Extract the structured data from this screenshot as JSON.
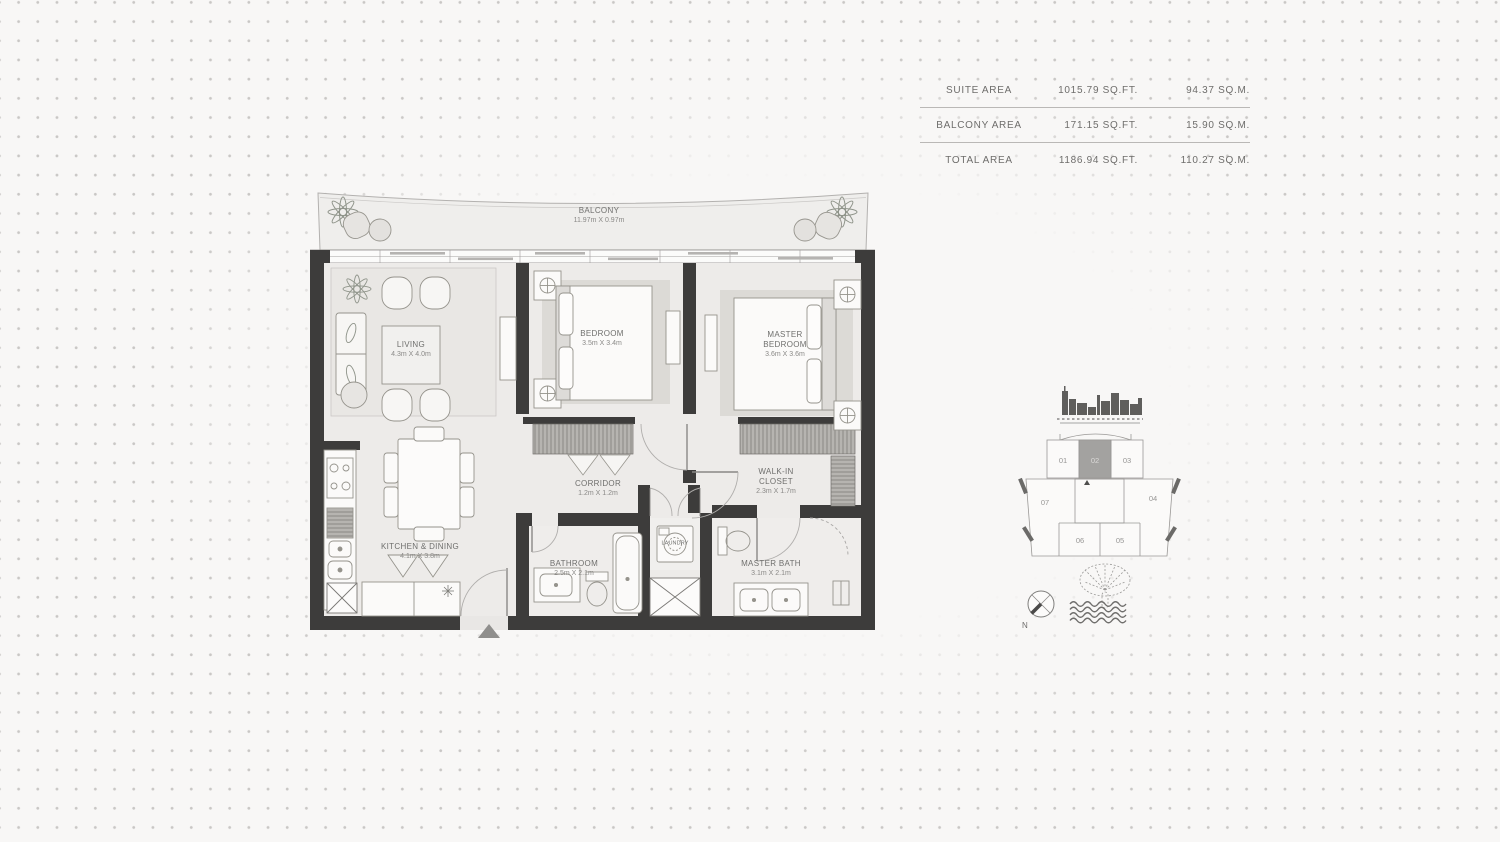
{
  "area_table": {
    "rows": [
      {
        "label": "SUITE AREA",
        "sqft": "1015.79 SQ.FT.",
        "sqm": "94.37 SQ.M."
      },
      {
        "label": "BALCONY AREA",
        "sqft": "171.15 SQ.FT.",
        "sqm": "15.90 SQ.M."
      },
      {
        "label": "TOTAL AREA",
        "sqft": "1186.94 SQ.FT.",
        "sqm": "110.27 SQ.M."
      }
    ]
  },
  "floorplan": {
    "rooms": [
      {
        "name": "BALCONY",
        "dims": "11.97m X 0.97m"
      },
      {
        "name": "LIVING",
        "dims": "4.3m X 4.0m"
      },
      {
        "name": "BEDROOM",
        "dims": "3.5m X 3.4m"
      },
      {
        "name": "MASTER BEDROOM",
        "dims": "3.6m X 3.6m"
      },
      {
        "name": "CORRIDOR",
        "dims": "1.2m X 1.2m"
      },
      {
        "name": "WALK-IN CLOSET",
        "dims": "2.3m X 1.7m"
      },
      {
        "name": "KITCHEN & DINING",
        "dims": "4.1m X 3.8m"
      },
      {
        "name": "BATHROOM",
        "dims": "2.5m X 2.1m"
      },
      {
        "name": "LAUNDRY",
        "dims": ""
      },
      {
        "name": "MASTER BATH",
        "dims": "3.1m X 2.1m"
      }
    ]
  },
  "keyplan": {
    "units": [
      "01",
      "02",
      "03",
      "04",
      "05",
      "06",
      "07"
    ],
    "highlighted_unit": "02",
    "compass_label": "N"
  },
  "colors": {
    "wall": "#3d3c3b",
    "floor": "#edebe9",
    "highlight_unit": "#a3a2a0",
    "background": "#f8f7f6",
    "dot": "#cac8c6"
  }
}
